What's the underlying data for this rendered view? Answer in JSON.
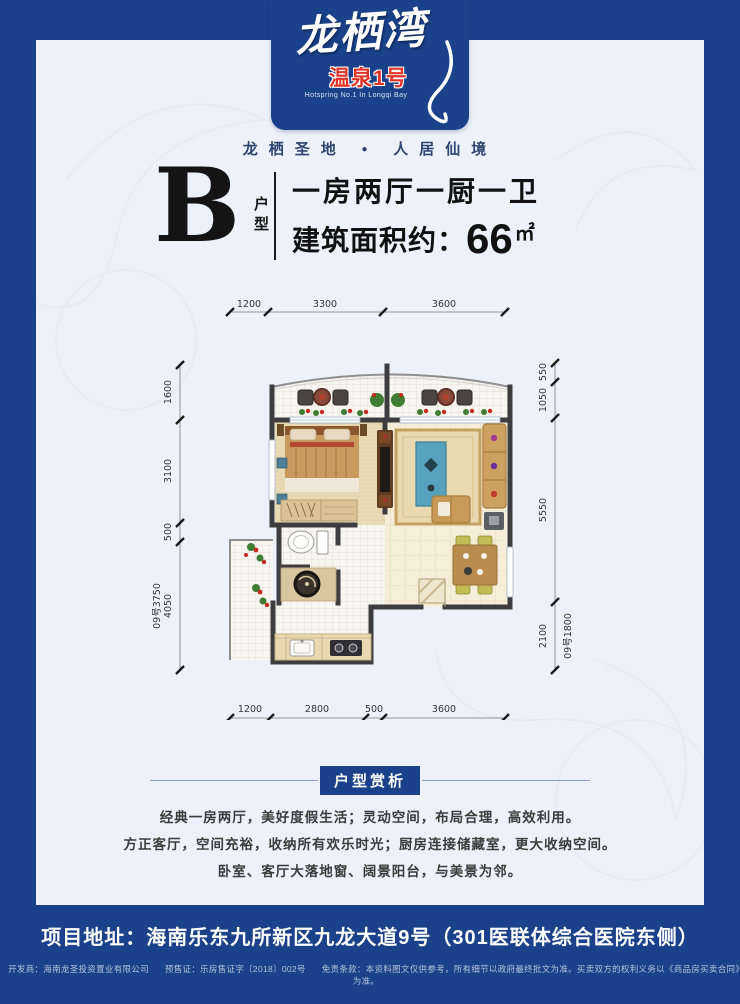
{
  "brand": {
    "logo_main": "龙栖湾",
    "logo_sub": "温泉1号",
    "logo_en": "Hotspring No.1 In Longqi Bay",
    "slogan_left": "龙栖圣地",
    "slogan_sep": "●",
    "slogan_right": "人居仙境"
  },
  "unit": {
    "letter": "B",
    "type_label": "户型",
    "line1": "一房两厅一厨一卫",
    "area_label": "建筑面积约：",
    "area_value": "66",
    "area_unit": "㎡"
  },
  "plan": {
    "dims": {
      "top": [
        "1200",
        "3300",
        "3600"
      ],
      "bottom": [
        "1200",
        "2800",
        "500",
        "3600"
      ],
      "left": [
        "1600",
        "3100",
        "500",
        "4050"
      ],
      "left_outer": "09号3750",
      "right": [
        "550",
        "1050",
        "5550",
        "2100"
      ],
      "right_inner": "09号1800"
    }
  },
  "analysis": {
    "header": "户型赏析",
    "lines": [
      "经典一房两厅，美好度假生活；灵动空间，布局合理，高效利用。",
      "方正客厅，空间充裕，收纳所有欢乐时光；厨房连接储藏室，更大收纳空间。",
      "卧室、客厅大落地窗、阔景阳台，与美景为邻。"
    ]
  },
  "footer": {
    "address": "项目地址：海南乐东九所新区九龙大道9号（301医联体综合医院东侧）",
    "developer": "开发商：海南龙圣投资置业有限公司",
    "permit": "预售证：乐房售证字〔2018〕002号",
    "disclaimer": "免责条款：本资料图文仅供参考，所有细节以政府最终批文为准。买卖双方的权利义务以《商品房买卖合同》为准。"
  },
  "colors": {
    "frame_blue": "#1a4189",
    "accent_red": "#e03428",
    "panel_bg": "#edf2fa",
    "wall": "#3d3d40"
  }
}
